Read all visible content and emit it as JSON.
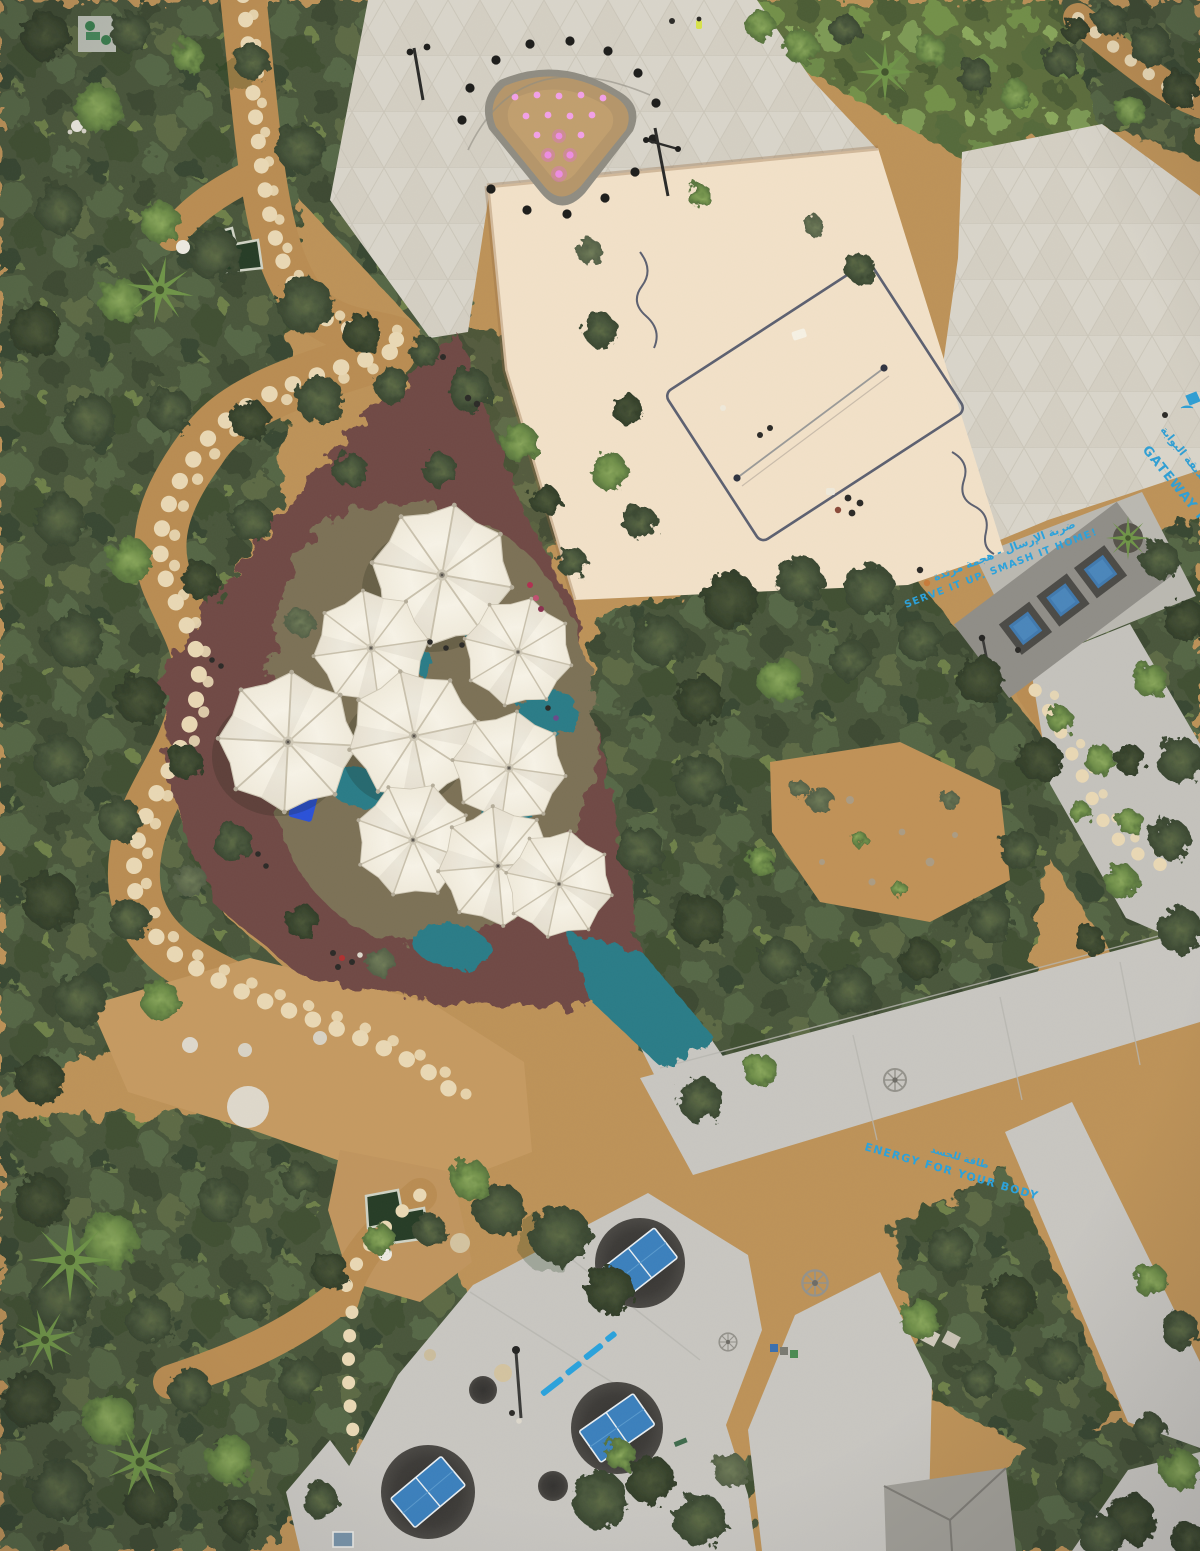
{
  "scene": {
    "kind": "aerial-drone-photo-of-park",
    "park_name_visible": "GATEWAY PARK"
  },
  "painted_texts": {
    "serve": {
      "en": "SERVE IT UP. SMASH IT HOME!",
      "ar": "ضربة الإرسال - هجمة مرتدة",
      "color": "#2aa2dc"
    },
    "park": {
      "en": "GATEWAY PARK",
      "ar": "حديقة البوابة",
      "color": "#2f9fd4"
    },
    "energy": {
      "en": "ENERGY FOR YOUR BODY",
      "ar": "طاقة للجسد",
      "color": "#2aa2dc"
    }
  },
  "features": {
    "umbrellas": {
      "count": 9,
      "canvas_color": "#f4efe2"
    },
    "trampolines": {
      "count": 3,
      "color": "#4079ae"
    },
    "table_tennis_tables": {
      "count": 3,
      "color": "#3b80bd"
    },
    "volleyball_court": {
      "surface": "sand",
      "sand_color": "#f2e1c8"
    },
    "splash_fountain": {
      "lights": 15,
      "perimeter_lamps": 14,
      "light_color": "#ef8fe0"
    },
    "ponds": {
      "count": 2,
      "water_color": "#2c3f28"
    },
    "playground": {
      "rubber_color": "#6f4a44",
      "ground_color": "#7b7156",
      "teal_color": "#2a7c87"
    }
  },
  "palette": {
    "vegetation_dark": "#3f4c33",
    "vegetation_mid": "#55633f",
    "vegetation_bright": "#7d9a54",
    "dirt_path": "#bb8f55",
    "stepping_stone": "#ead9b5",
    "plaza_tile": "#d9d5ca",
    "concrete": "#c8c6c1",
    "pad_charcoal": "#3b3936"
  }
}
